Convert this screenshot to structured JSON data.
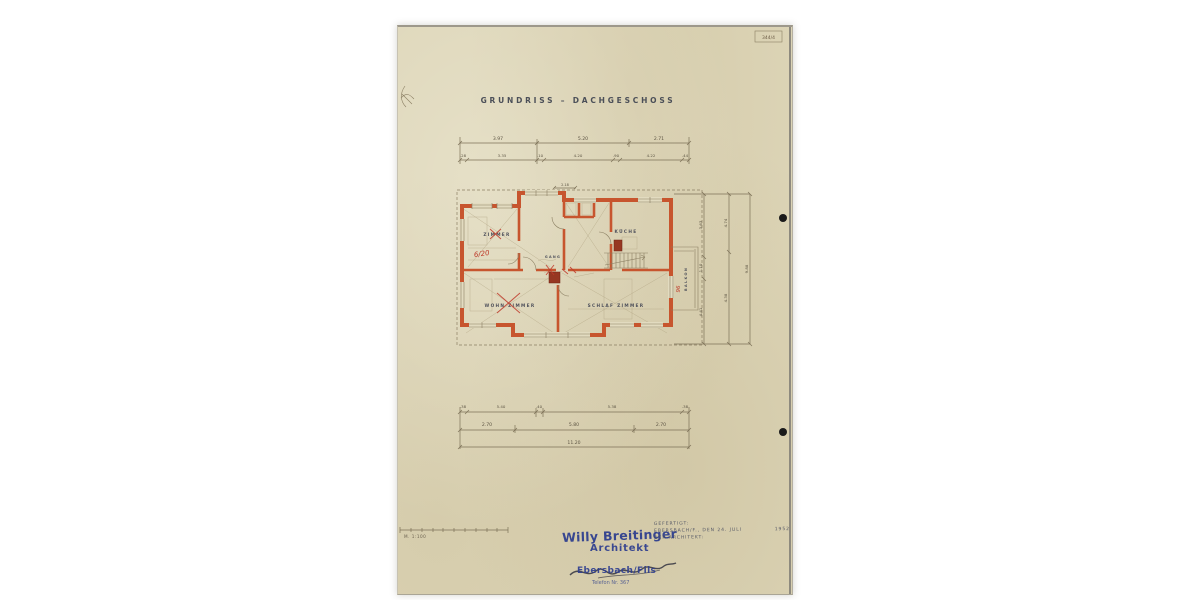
{
  "page": {
    "sheet_number": "344/4",
    "title": "GRUNDRISS – DACHGESCHOSS",
    "scale_label": "M. 1:100"
  },
  "colors": {
    "wall_orange": "#c7552e",
    "stamp_blue": "#2e3e8f",
    "red_pencil": "#bf3a2a",
    "paper": "#dcd4b6"
  },
  "rooms": {
    "zimmer": "ZIMMER",
    "kueche": "KÜCHE",
    "gang": "GANG",
    "wohnzimmer": "WOHN ZIMMER",
    "schlafzimmer": "SCHLAF ZIMMER",
    "balkon": "BALKON"
  },
  "notes": {
    "red_fraction": "6/20",
    "red_balcony": "96",
    "top_small_dim": "2.18"
  },
  "dims": {
    "top_row1": [
      "3.97",
      "5.20",
      "2.71"
    ],
    "top_row2": [
      ".28",
      "3.35",
      ".10",
      "4.20",
      ".90",
      "4.22",
      ".44"
    ],
    "bottom_row1": [
      ".38",
      "5.40",
      ".40",
      "5.38",
      ".38"
    ],
    "bottom_row2": [
      "2.70",
      "5.80",
      "2.70"
    ],
    "bottom_total": "11.20",
    "right_chain1": [
      "3.63",
      "1.10",
      "4.41"
    ],
    "right_chain2": [
      "4.74",
      "4.38"
    ],
    "right_total": "9.88"
  },
  "stamp": {
    "name": "Willy Breitinger",
    "role": "Architekt",
    "city": "Ebersbach/Fils",
    "phone": "Telefon Nr. 367"
  },
  "cert": {
    "label": "GEFERTIGT:",
    "place_date": "EBERSBACH/F., DEN 24. JULI",
    "year": "1952",
    "by": "DER ARCHITEKT:"
  }
}
